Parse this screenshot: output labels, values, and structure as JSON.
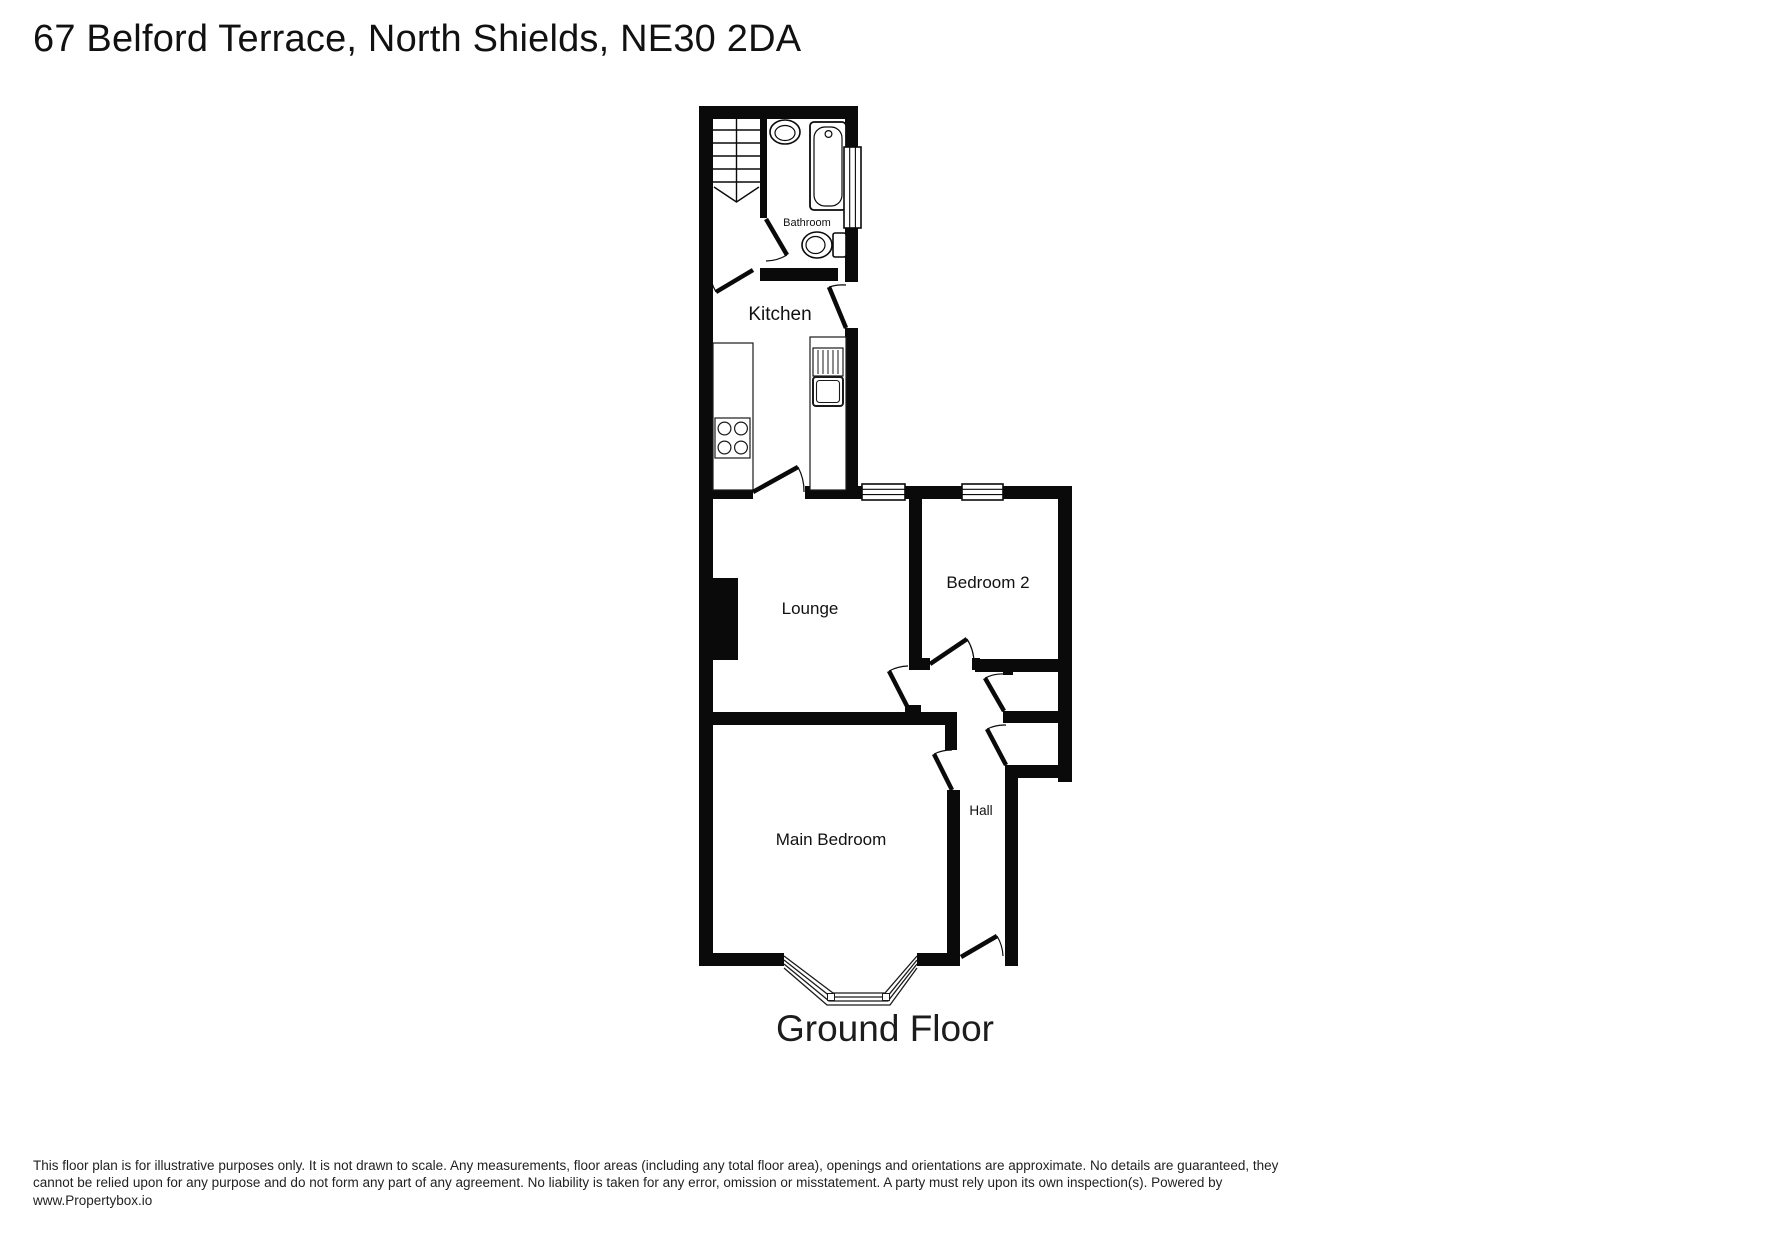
{
  "title": "67 Belford Terrace, North Shields, NE30 2DA",
  "floor_label": "Ground Floor",
  "rooms": {
    "bathroom": "Bathroom",
    "kitchen": "Kitchen",
    "lounge": "Lounge",
    "bedroom2": "Bedroom 2",
    "main_bedroom": "Main Bedroom",
    "hall": "Hall"
  },
  "disclaimer": "This floor plan is for illustrative purposes only. It is not drawn to scale. Any measurements, floor areas (including any total floor area), openings and orientations are approximate. No details are guaranteed, they cannot be relied upon for any purpose and do not form any part of any agreement. No liability is taken for any error, omission or misstatement. A party must rely upon its own inspection(s). Powered by www.Propertybox.io",
  "colors": {
    "wall": "#0a0a0a",
    "background": "#ffffff",
    "text": "#111111"
  }
}
